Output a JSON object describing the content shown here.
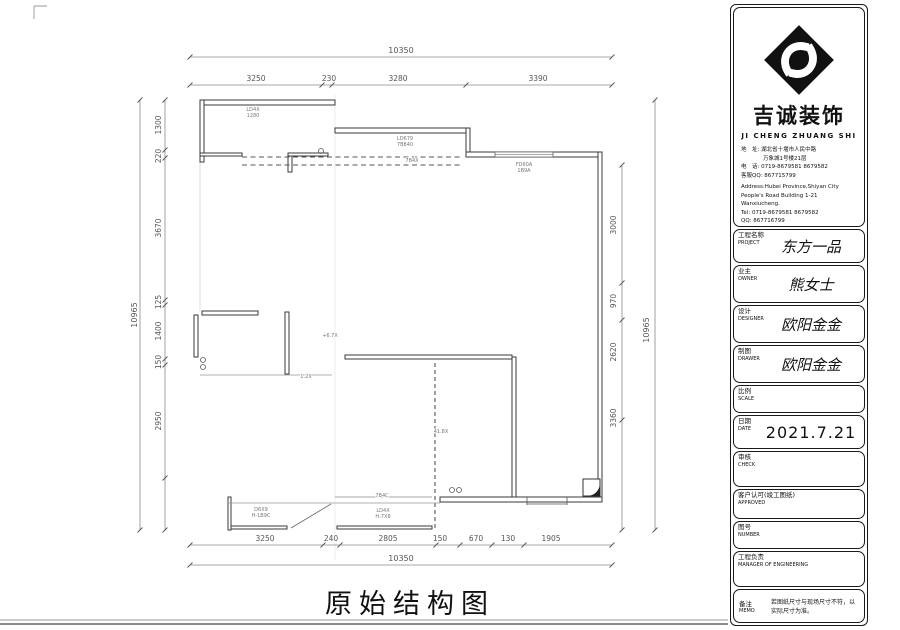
{
  "sheet": {
    "title": "原始结构图",
    "title_block": {
      "company_cn": "吉诚装饰",
      "company_en": "JI CHENG ZHUANG SHI",
      "contact_cn": [
        "地　址: 湖北省十堰市人民中路",
        "　　　　万象城1号楼21层",
        "电　话: 0719-8679581  8679582",
        "客服QQ: 867715799"
      ],
      "contact_en": [
        "Address:Hubei Province,Shiyan City",
        "People's Road Building 1-21",
        "Wanxiucheng.",
        "Tel: 0719-8679581  8679582",
        "QQ: 867716799"
      ],
      "fields": [
        {
          "label_cn": "工程名称",
          "label_en": "PROJECT",
          "value": "东方一品"
        },
        {
          "label_cn": "业主",
          "label_en": "OWNER",
          "value": "熊女士"
        },
        {
          "label_cn": "设计",
          "label_en": "DESIGNER",
          "value": "欧阳金金"
        },
        {
          "label_cn": "制图",
          "label_en": "DRAWER",
          "value": "欧阳金金"
        },
        {
          "label_cn": "比例",
          "label_en": "SCALE",
          "value": ""
        },
        {
          "label_cn": "日期",
          "label_en": "DATE",
          "value": "2021.7.21"
        },
        {
          "label_cn": "审核",
          "label_en": "CHECK",
          "value": ""
        },
        {
          "label_cn": "客户认可(竣工图纸)",
          "label_en": "APPROVED",
          "value": ""
        },
        {
          "label_cn": "图号",
          "label_en": "NUMBER",
          "value": ""
        },
        {
          "label_cn": "工程负责",
          "label_en": "MANAGER OF ENGINEERING",
          "value": ""
        },
        {
          "label_cn": "备注",
          "label_en": "MEMO",
          "value": "若图纸尺寸与现场尺寸不符，以实际尺寸为准。"
        }
      ]
    }
  },
  "plan": {
    "dims": {
      "top_total": "10350",
      "top_chain": [
        "3250",
        "230",
        "3280",
        "3390"
      ],
      "bottom_total": "10350",
      "bottom_chain": [
        "3250",
        "240",
        "2805",
        "150",
        "670",
        "130",
        "1905"
      ],
      "left_total": "10965",
      "left_chain": [
        "1300",
        "220",
        "3670",
        "125",
        "1400",
        "150",
        "2950"
      ],
      "right_total": "10965",
      "right_chain": [
        "3000",
        "970",
        "2620",
        "3360"
      ]
    },
    "annotations": [
      "LD4X",
      "1280",
      "LD679",
      "7B840",
      "7B4X",
      "FD60A",
      "1B9A",
      "D6X9",
      "H-1B9C",
      "LD4X",
      "H-7X8",
      "7B4C",
      "+6.7X",
      "1.2X",
      "41.8X"
    ]
  }
}
